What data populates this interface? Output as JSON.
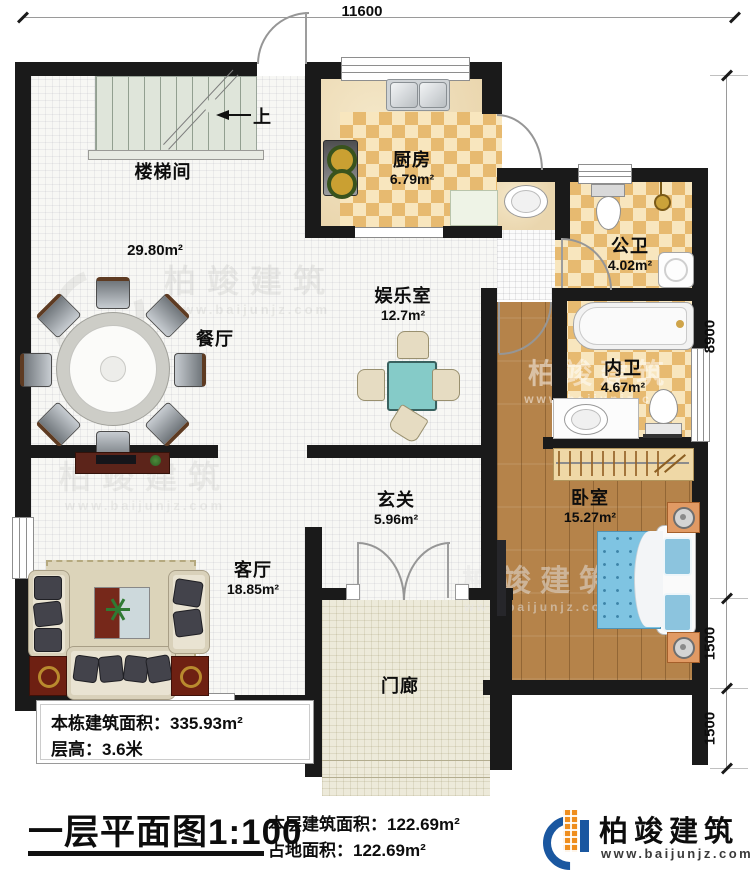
{
  "dims": {
    "top": "11600",
    "right_total": "8900",
    "right_seg1": "1500",
    "right_seg2": "1500"
  },
  "stairs": {
    "label": "楼梯间",
    "up": "上"
  },
  "areas": {
    "hall": "29.80m²"
  },
  "rooms": {
    "dining": {
      "label": "餐厅"
    },
    "kitchen": {
      "label": "厨房",
      "area": "6.79m²"
    },
    "entertainment": {
      "label": "娱乐室",
      "area": "12.7m²"
    },
    "public_bath": {
      "label": "公卫",
      "area": "4.02m²"
    },
    "private_bath": {
      "label": "内卫",
      "area": "4.67m²"
    },
    "foyer": {
      "label": "玄关",
      "area": "5.96m²"
    },
    "living": {
      "label": "客厅",
      "area": "18.85m²"
    },
    "bedroom": {
      "label": "卧室",
      "area": "15.27m²"
    },
    "porch": {
      "label": "门廊"
    }
  },
  "stats_box": {
    "building_area": "本栋建筑面积：335.93m²",
    "floor_height": "层高：3.6米"
  },
  "plan_title": "一层平面图1:100",
  "totals": {
    "floor_area": "本层建筑面积：122.69m²",
    "land_area": "占地面积：122.69m²"
  },
  "logo": {
    "name": "柏竣建筑",
    "url": "www.baijunjz.com"
  },
  "watermark": {
    "text": "柏竣建筑",
    "url": "www.baijunjz.com"
  },
  "colors": {
    "wall": "#1a1a1a",
    "tile_accent": "#e7ba70",
    "wood": "#b5834a",
    "logo_blue": "#1a57a0",
    "logo_orange": "#ef8e1e"
  }
}
